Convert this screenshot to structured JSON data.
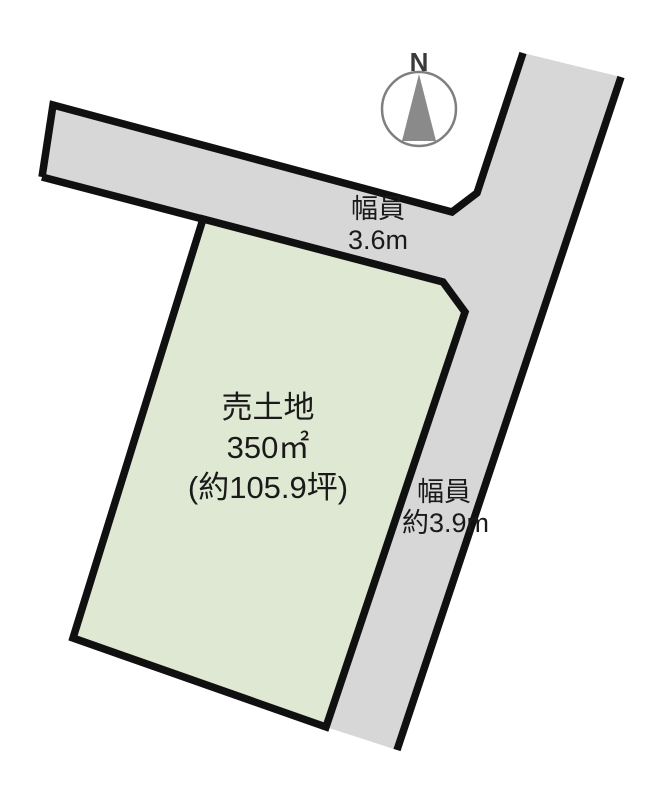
{
  "compass": {
    "label": "N"
  },
  "roads": {
    "top": {
      "width_label": [
        "幅員",
        "3.6m"
      ]
    },
    "right": {
      "width_label": [
        "幅員",
        "約3.9m"
      ]
    }
  },
  "plot": {
    "title": "売土地",
    "area_sqm": "350㎡",
    "area_tsubo": "(約105.9坪)"
  },
  "colors": {
    "background": "#ffffff",
    "road_fill": "#d7d7d7",
    "plot_fill": "#dfe8d2",
    "border": "#101010",
    "text": "#1a1a1a",
    "compass_gray": "#8a8a8a",
    "compass_ring": "#7f7f7f",
    "compass_text": "#3a3a3a"
  }
}
